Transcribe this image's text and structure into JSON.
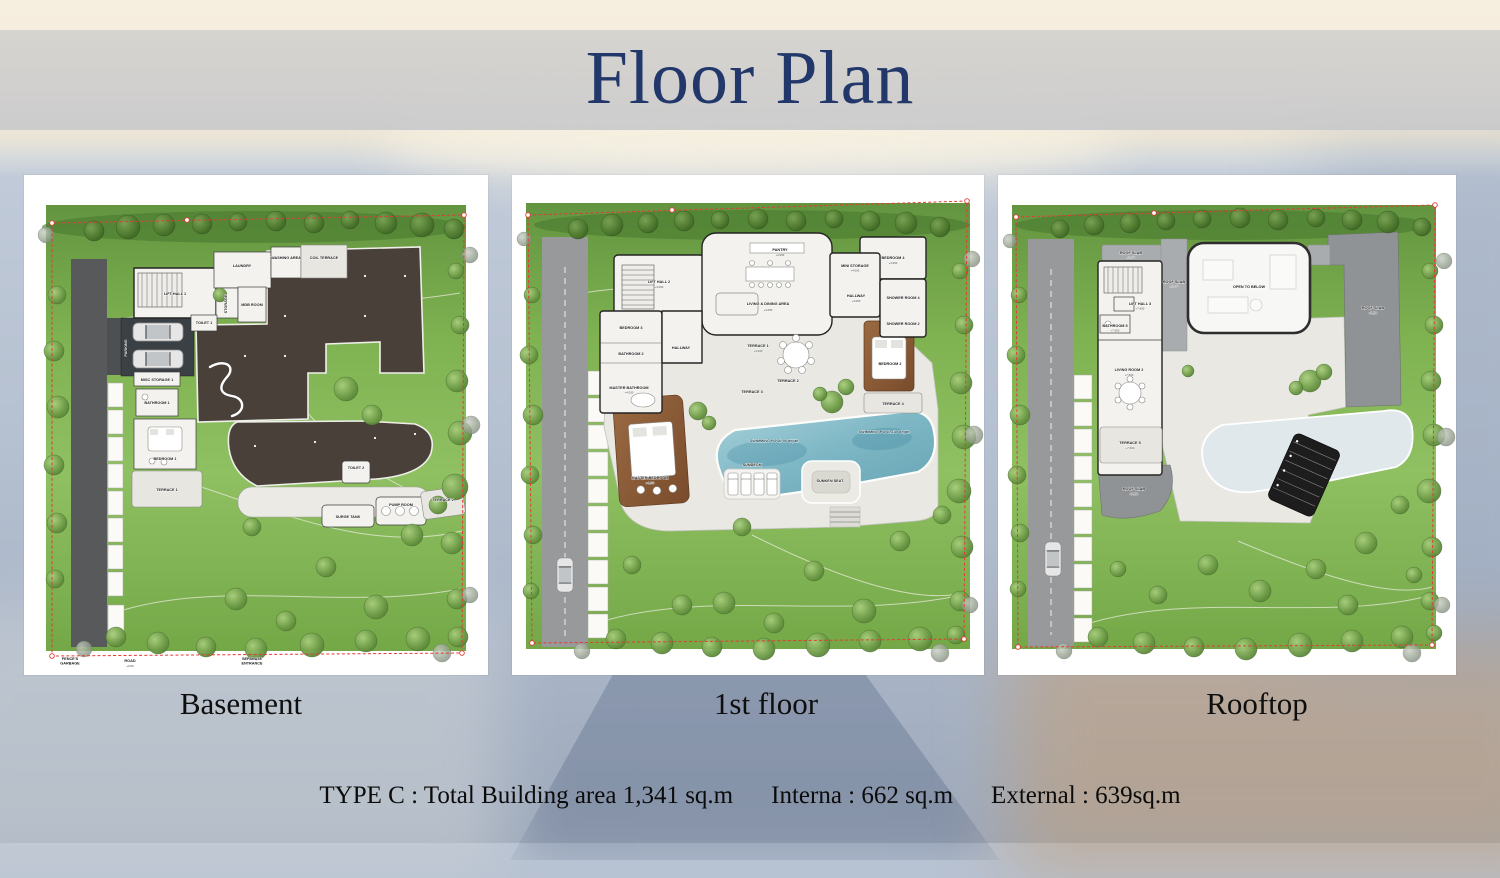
{
  "slide": {
    "title": "Floor Plan"
  },
  "footer": {
    "type_area": "TYPE  C  :  Total Building area 1,341  sq.m",
    "internal": "Interna : 662 sq.m",
    "external": "External : 639sq.m"
  },
  "elevations": {
    "first_floor": "+4.050",
    "terrace": "+4.000",
    "slab": "+7.550",
    "roof_rooms": "+7.600",
    "road": "+0.00"
  },
  "panels": {
    "basement": {
      "caption": "Basement",
      "rooms": {
        "laundry": "LAUNDRY",
        "washing_area": "WASHING AREA",
        "coil_terrace": "COIL TERRACE",
        "lift_hall_1": "LIFT HALL 1",
        "storage": "STORAGE",
        "mdb_room": "MDB ROOM",
        "toilet_1": "TOILET 1",
        "parking": "PARKING",
        "misc_storage_1": "MISC STORAGE 1",
        "bathroom_1": "BATHROOM 1",
        "bedroom_1": "BEDROOM 1",
        "terrace_1": "TERRACE 1",
        "surge_tank": "SURGE TANK",
        "pump_room": "PUMP ROOM",
        "toilet_2": "TOILET 2",
        "terrace_2": "TERRACE 2"
      },
      "site": {
        "fence_line1": "FENCE'S",
        "fence_line2": "GARBAGE",
        "road": "ROAD",
        "separate_line1": "SEPARATE",
        "separate_line2": "ENTRANCE"
      }
    },
    "first": {
      "caption": "1st floor",
      "rooms": {
        "lift_hall_2": "LIFT HALL 2",
        "pantry": "PANTRY",
        "mini_storage": "MINI STORAGE",
        "bedroom_4": "BEDROOM 4",
        "hallway": "HALLWAY",
        "shower_room_4": "SHOWER ROOM 4",
        "shower_room_2": "SHOWER ROOM 2",
        "bedroom_2": "BEDROOM 2",
        "living_dining": "LIVING & DINING AREA",
        "bedroom_3": "BEDROOM 3",
        "bathroom_2": "BATHROOM 2",
        "hallway_2": "HALLWAY",
        "master_bathroom": "MASTER BATHROOM",
        "master_bedroom": "MASTER BEDROOM",
        "terrace_1": "TERRACE 1",
        "terrace_2": "TERRACE 2",
        "terrace_3": "TERRACE 3",
        "terrace_4": "TERRACE 4"
      },
      "pool": {
        "left": "SWIMMING POOL 90 depth",
        "right": "SWIMMING POOL 140 depth",
        "sundeck": "SUNDECK",
        "sunken_seat": "SUNKEN SEAT"
      }
    },
    "rooftop": {
      "caption": "Rooftop",
      "rooms": {
        "roof_slab": "ROOF SLAB",
        "lift_hall_3": "LIFT HALL 3",
        "bathroom_5": "BATHROOM 5",
        "living_room_2": "LIVING ROOM 2",
        "terrace_5": "TERRACE 5",
        "open_to_below": "OPEN TO BELOW"
      }
    }
  }
}
